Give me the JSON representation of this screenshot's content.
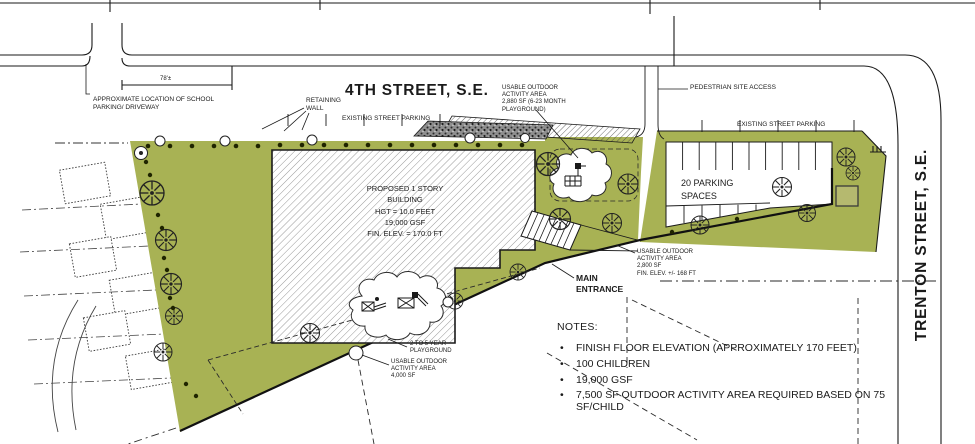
{
  "streets": {
    "fourth_street": "4TH STREET, S.E.",
    "trenton_street": "TRENTON STREET, S.E."
  },
  "dimension_label": "78'±",
  "labels": {
    "school_parking": "APPROXIMATE LOCATION OF SCHOOL\nPARKING/ DRIVEWAY",
    "retaining_wall": "RETAINING\nWALL",
    "existing_street_parking_west": "EXISTING STREET PARKING",
    "existing_street_parking_east": "EXISTING STREET PARKING",
    "pedestrian_site_access": "PEDESTRIAN SITE ACCESS",
    "outdoor_area_infant": "USABLE OUTDOOR\nACTIVITY AREA\n2,880 SF (6-23 MONTH\nPLAYGROUND)",
    "outdoor_area_east": "USABLE OUTDOOR\nACTIVITY AREA\n2,800 SF\nFIN. ELEV. +/- 168 FT",
    "outdoor_area_south": "USABLE OUTDOOR\nACTIVITY AREA\n4,000 SF",
    "playground_2_to_5": "2 TO 5 YEAR\nPLAYGROUND",
    "main_entrance": "MAIN\nENTRANCE",
    "parking_spaces": "20 PARKING\nSPACES"
  },
  "building_label": "PROPOSED 1 STORY\nBUILDING\nHGT = 10.0 FEET\n19,000 GSF\nFIN. ELEV. = 170.0 FT",
  "notes": {
    "title": "NOTES:",
    "bullet": "•",
    "items": [
      "FINISH FLOOR ELEVATION (APPROXIMATELY 170 FEET)",
      "100 CHILDREN",
      "19,000 GSF",
      "7,500 SF OUTDOOR ACTIVITY AREA REQUIRED BASED ON 75\nSF/CHILD"
    ]
  },
  "colors": {
    "site_green": "#a8b254",
    "line_ink": "#1a1a1a",
    "wall_gray": "#8f8f8f"
  }
}
